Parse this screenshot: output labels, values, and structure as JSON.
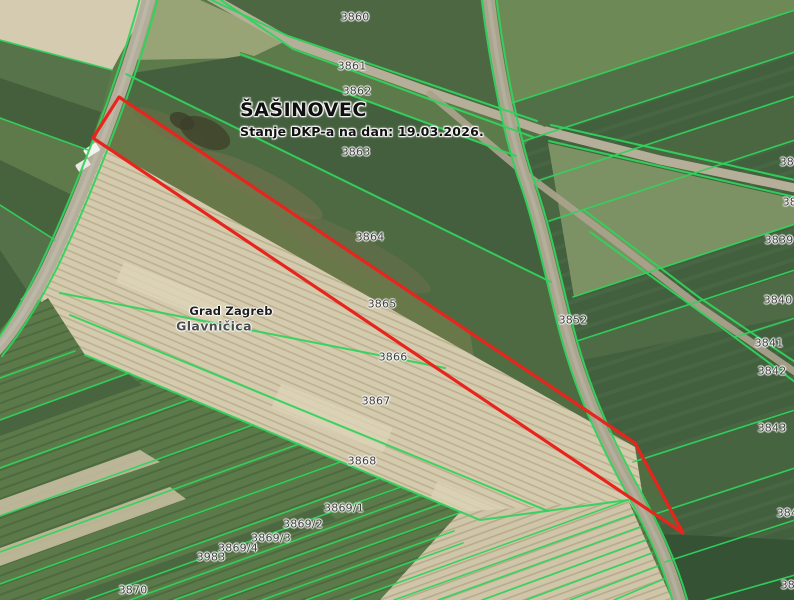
{
  "map": {
    "overlay": {
      "title": "ŠAŠINOVEC",
      "subtitle": "Stanje DKP-a na dan: 19.03.2026."
    },
    "selected_parcel": "3865",
    "admin_labels": [
      {
        "text": "Grad Zagreb",
        "style": "admin",
        "x": 231,
        "y": 311
      },
      {
        "text": "Glavničica",
        "style": "settlement",
        "x": 214,
        "y": 326
      }
    ],
    "parcel_labels": [
      {
        "text": "3860",
        "x": 355,
        "y": 17
      },
      {
        "text": "3861",
        "x": 352,
        "y": 66
      },
      {
        "text": "3862",
        "x": 357,
        "y": 91
      },
      {
        "text": "3863",
        "x": 356,
        "y": 152
      },
      {
        "text": "3864",
        "x": 370,
        "y": 237
      },
      {
        "text": "3865",
        "x": 382,
        "y": 304
      },
      {
        "text": "3866",
        "x": 393,
        "y": 357
      },
      {
        "text": "3867",
        "x": 376,
        "y": 401
      },
      {
        "text": "3868",
        "x": 362,
        "y": 461
      },
      {
        "text": "3869/1",
        "x": 344,
        "y": 508
      },
      {
        "text": "3869/2",
        "x": 303,
        "y": 524
      },
      {
        "text": "3869/3",
        "x": 271,
        "y": 538
      },
      {
        "text": "3869/4",
        "x": 238,
        "y": 548
      },
      {
        "text": "3983",
        "x": 211,
        "y": 557
      },
      {
        "text": "3870",
        "x": 133,
        "y": 590
      },
      {
        "text": "3852",
        "x": 573,
        "y": 320
      },
      {
        "text": "3837",
        "x": 794,
        "y": 162
      },
      {
        "text": "3838",
        "x": 797,
        "y": 202
      },
      {
        "text": "3839",
        "x": 779,
        "y": 240
      },
      {
        "text": "3840",
        "x": 778,
        "y": 300
      },
      {
        "text": "3841",
        "x": 769,
        "y": 343
      },
      {
        "text": "3842",
        "x": 772,
        "y": 371
      },
      {
        "text": "3843",
        "x": 772,
        "y": 428
      },
      {
        "text": "3844",
        "x": 791,
        "y": 513
      },
      {
        "text": "3845",
        "x": 795,
        "y": 585
      }
    ],
    "colors": {
      "parcel_line": "#30d35c",
      "selected_outline": "#e8251c",
      "road": "#b3ae9b",
      "cultivated_field": "#d4caad"
    }
  }
}
